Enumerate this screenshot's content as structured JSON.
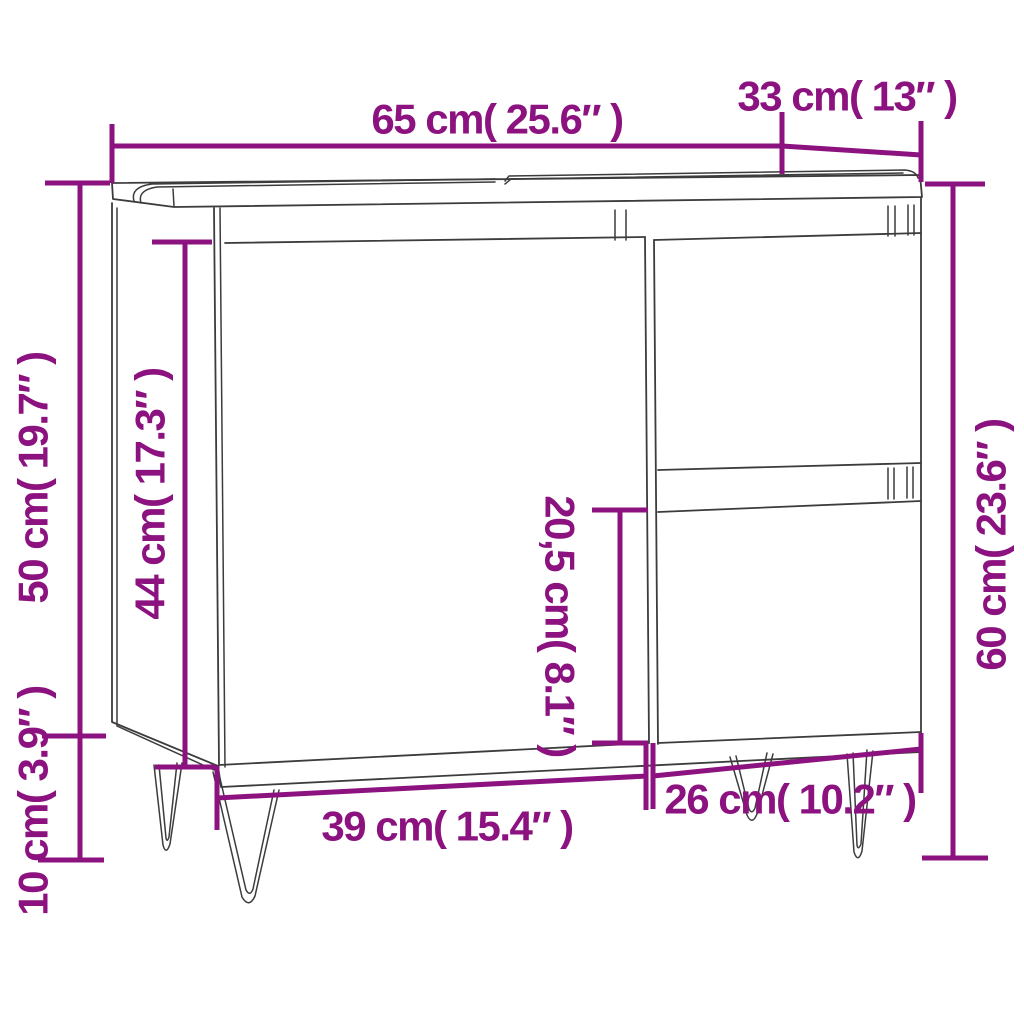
{
  "diagram": {
    "subject": "bathroom sink cabinet line drawing with countertop basin, left door, two right drawers and four hairpin legs",
    "colors": {
      "dimension_accent": "#8C1280",
      "line_art": "#3C3C3C",
      "background": "#FFFFFF"
    },
    "dimensions": [
      {
        "id": "overall-width",
        "label": "65 cm( 25.6″ )",
        "orientation": "horizontal",
        "position": "top"
      },
      {
        "id": "depth",
        "label": "33 cm( 13″ )",
        "orientation": "horizontal",
        "position": "top-right"
      },
      {
        "id": "carcass-height",
        "label": "50 cm( 19.7″ )",
        "orientation": "vertical",
        "position": "left-outer"
      },
      {
        "id": "door-height",
        "label": "44 cm( 17.3″ )",
        "orientation": "vertical",
        "position": "left-inner"
      },
      {
        "id": "drawer-front-height",
        "label": "20,5 cm( 8.1″ )",
        "orientation": "vertical",
        "position": "center"
      },
      {
        "id": "overall-height",
        "label": "60 cm( 23.6″ )",
        "orientation": "vertical",
        "position": "right"
      },
      {
        "id": "door-section-width",
        "label": "39 cm( 15.4″ )",
        "orientation": "horizontal",
        "position": "bottom-left"
      },
      {
        "id": "drawer-section-width",
        "label": "26 cm( 10.2″ )",
        "orientation": "horizontal",
        "position": "bottom-right"
      },
      {
        "id": "leg-height",
        "label": "10 cm( 3.9″ )",
        "orientation": "vertical",
        "position": "bottom-left-outer"
      }
    ]
  }
}
